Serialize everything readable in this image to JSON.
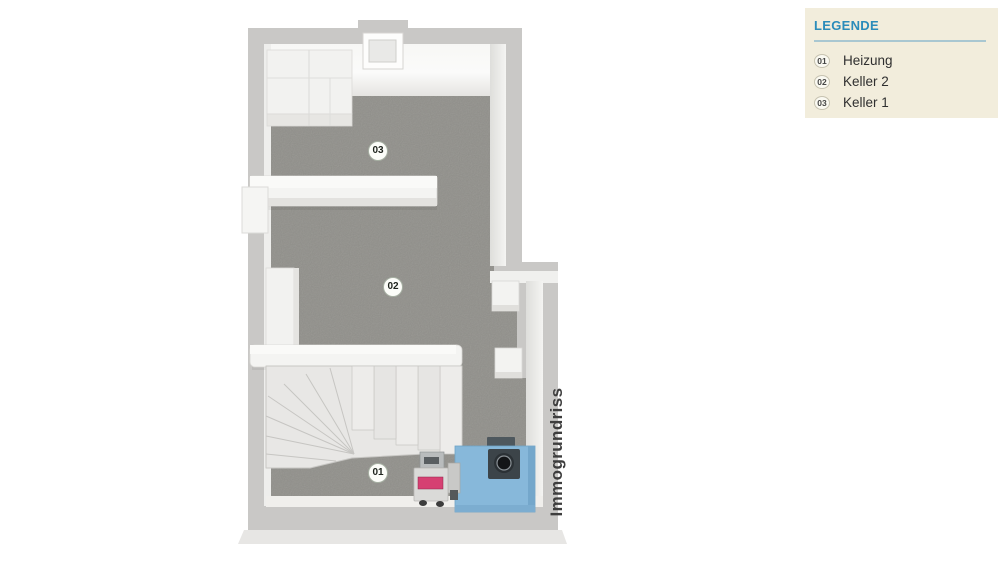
{
  "legend": {
    "title": "LEGENDE",
    "items": [
      {
        "code": "01",
        "label": "Heizung"
      },
      {
        "code": "02",
        "label": "Keller 2"
      },
      {
        "code": "03",
        "label": "Keller 1"
      }
    ],
    "colors": {
      "background": "#f2eddc",
      "title": "#2b8cba",
      "divider": "#a9c7d1",
      "text": "#2f2f2f"
    }
  },
  "floorplan": {
    "watermark": "Immogrundriss",
    "rooms": [
      {
        "code": "01",
        "name": "Heizung"
      },
      {
        "code": "02",
        "name": "Keller 2"
      },
      {
        "code": "03",
        "name": "Keller 1"
      }
    ],
    "colors": {
      "wall_top": "#c9c8c6",
      "wall_face": "#f2f2f0",
      "floor": "#a2a19c",
      "stair_tread": "#e8e7e5",
      "heater_blue": "#87b8da",
      "heater_cap": "#3c4449",
      "burner_accent": "#d64072",
      "watermark_text": "#3e3e3e"
    }
  }
}
